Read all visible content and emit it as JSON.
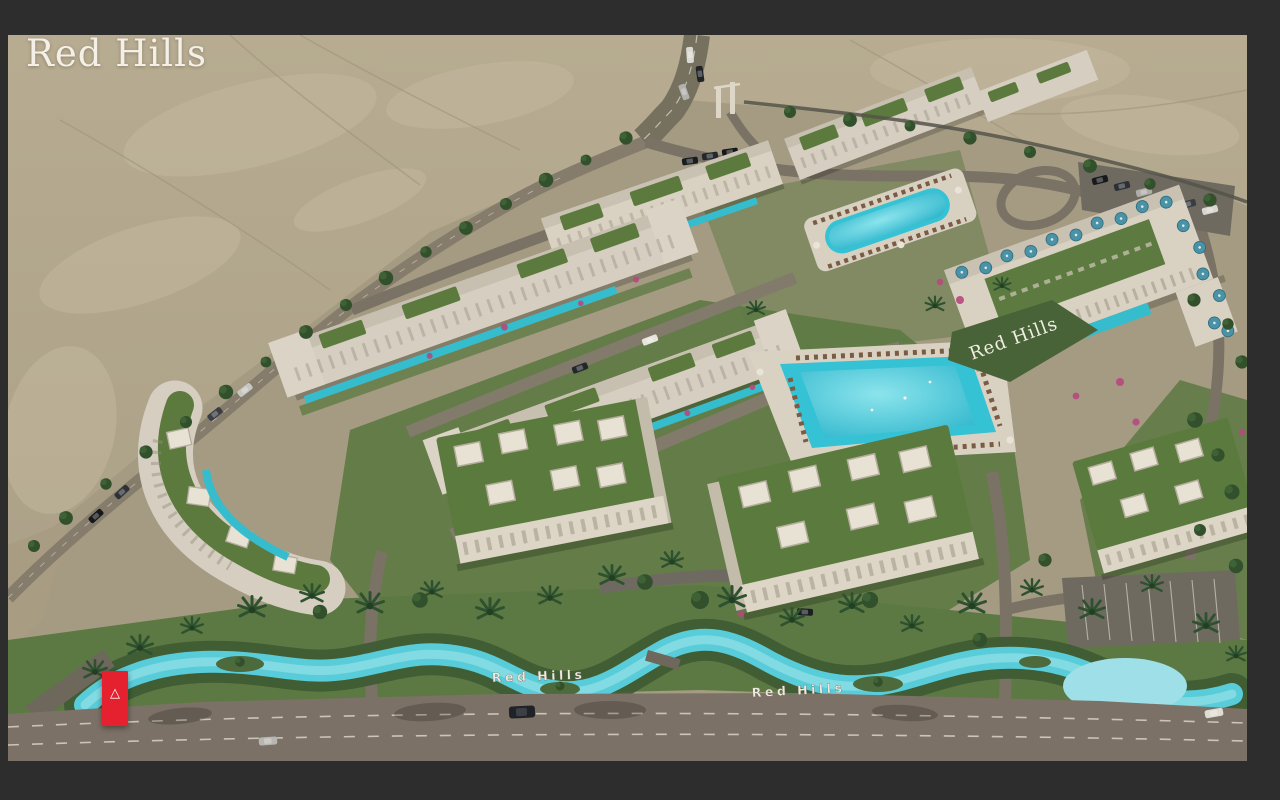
{
  "branding": {
    "logo_text": "Red Hills"
  },
  "marker_button": {
    "glyph": "△",
    "color": "#e6212f"
  },
  "scene": {
    "signs": {
      "hill_sign": "Red Hills",
      "river_sign_left": "Red Hills",
      "river_sign_right": "Red Hills"
    },
    "palette": {
      "frame": "#2d2d2d",
      "desert": "#b3a88d",
      "compound_ground": "#a49b82",
      "lawn": "#5d7943",
      "road": "#7a7265",
      "building": "#d9d1c2",
      "roof_green": "#5c7a3e",
      "pool": "#35c2d4",
      "river": "#58ccd8",
      "lagoon": "#9fe0e8",
      "umbrella": "#4a92a6",
      "brand_red": "#e6212f",
      "logo_white": "#f4f0e7"
    }
  }
}
